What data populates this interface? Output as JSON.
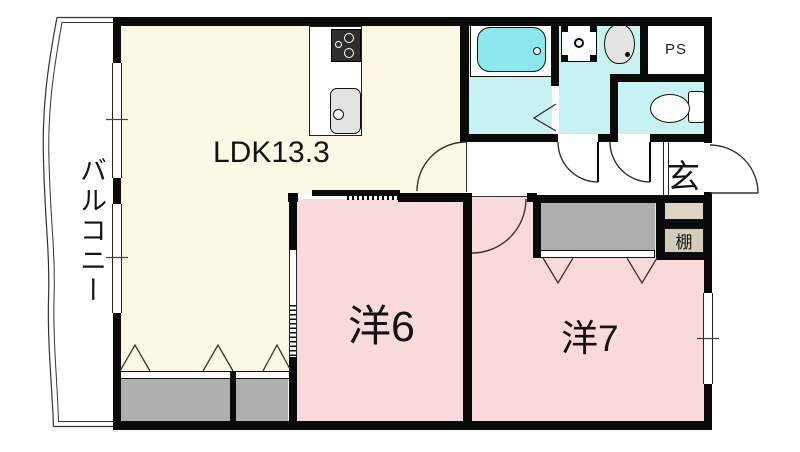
{
  "rooms": {
    "balcony": {
      "label": "バルコニー"
    },
    "ldk": {
      "label": "LDK13.3"
    },
    "room6": {
      "label": "洋6"
    },
    "room7": {
      "label": "洋7"
    },
    "genkan": {
      "label": "玄"
    },
    "shelf": {
      "label": "棚"
    },
    "ps": {
      "label": "PS"
    }
  },
  "icons": {
    "bathtub": "bathtub-icon",
    "toilet": "toilet-icon",
    "washing_machine": "washing-machine-pan-icon",
    "vanity": "vanity-sink-icon",
    "stove": "stove-icon",
    "kitchen_sink": "kitchen-sink-icon",
    "door_swing": "door-swing-arc",
    "folding_door": "folding-door-marker"
  },
  "colors": {
    "wall": "#0a0a0a",
    "ldk_floor": "#FBF8E3",
    "bedroom_floor": "#F9DADA",
    "wet_area_floor": "#C8F2F2",
    "bathtub": "#8DE8EE",
    "closet_gray": "#B0AFAF",
    "shelf_beige": "#D5CBB9",
    "shoe_cabinet_beige": "#DDD4C4",
    "fixture_gray": "#E3E3E3",
    "door_line": "#3F2E2E"
  }
}
